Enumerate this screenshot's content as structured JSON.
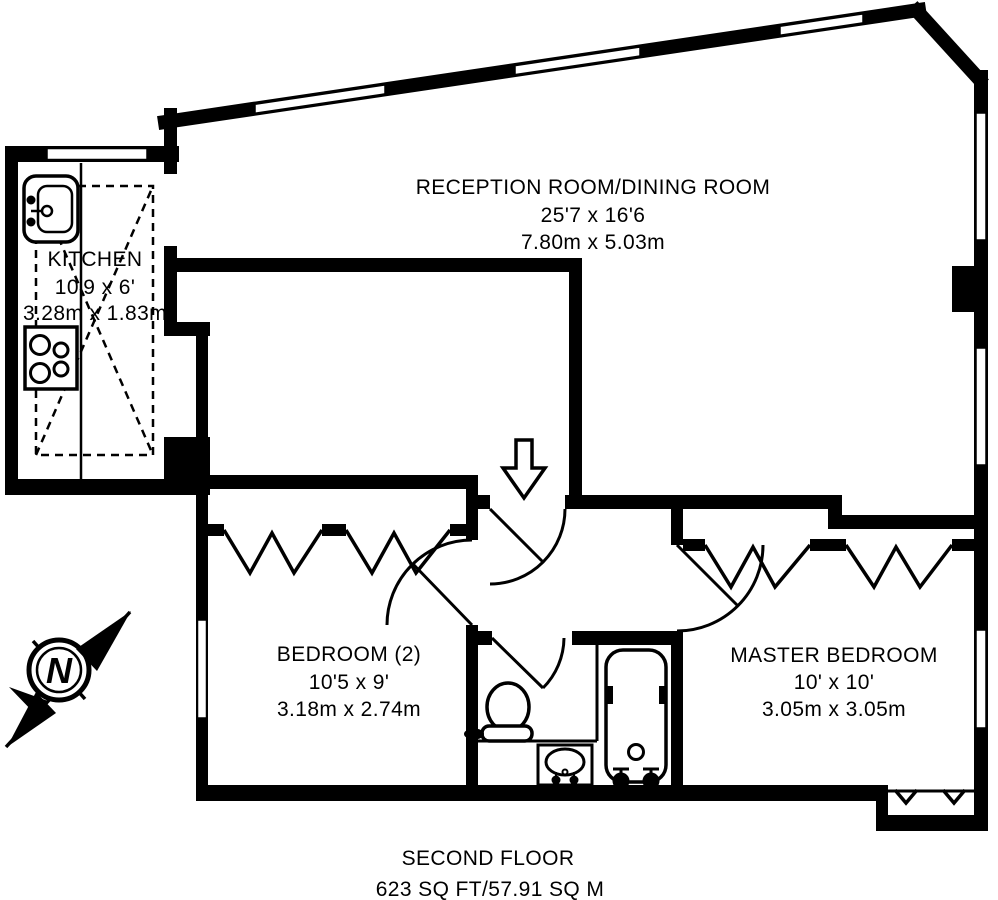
{
  "plan": {
    "rooms": {
      "reception": {
        "name": "RECEPTION ROOM/DINING ROOM",
        "imperial": "25'7 x 16'6",
        "metric": "7.80m x 5.03m"
      },
      "kitchen": {
        "name": "KITCHEN",
        "imperial": "10'9 x 6'",
        "metric": "3.28m x 1.83m"
      },
      "bedroom2": {
        "name": "BEDROOM (2)",
        "imperial": "10'5 x 9'",
        "metric": "3.18m x 2.74m"
      },
      "master": {
        "name": "MASTER BEDROOM",
        "imperial": "10' x 10'",
        "metric": "3.05m x 3.05m"
      }
    },
    "compass": {
      "label": "N"
    },
    "footer": {
      "floor": "SECOND FLOOR",
      "area": "623 SQ FT/57.91 SQ M"
    },
    "icons": [
      "sink-icon",
      "hob-icon",
      "toilet-icon",
      "basin-icon",
      "bathtub-icon",
      "compass-rose-icon",
      "entry-arrow-icon",
      "window",
      "door-swing",
      "wardrobe-zigzag"
    ],
    "colors": {
      "wall": "#000000",
      "background": "#ffffff"
    }
  }
}
